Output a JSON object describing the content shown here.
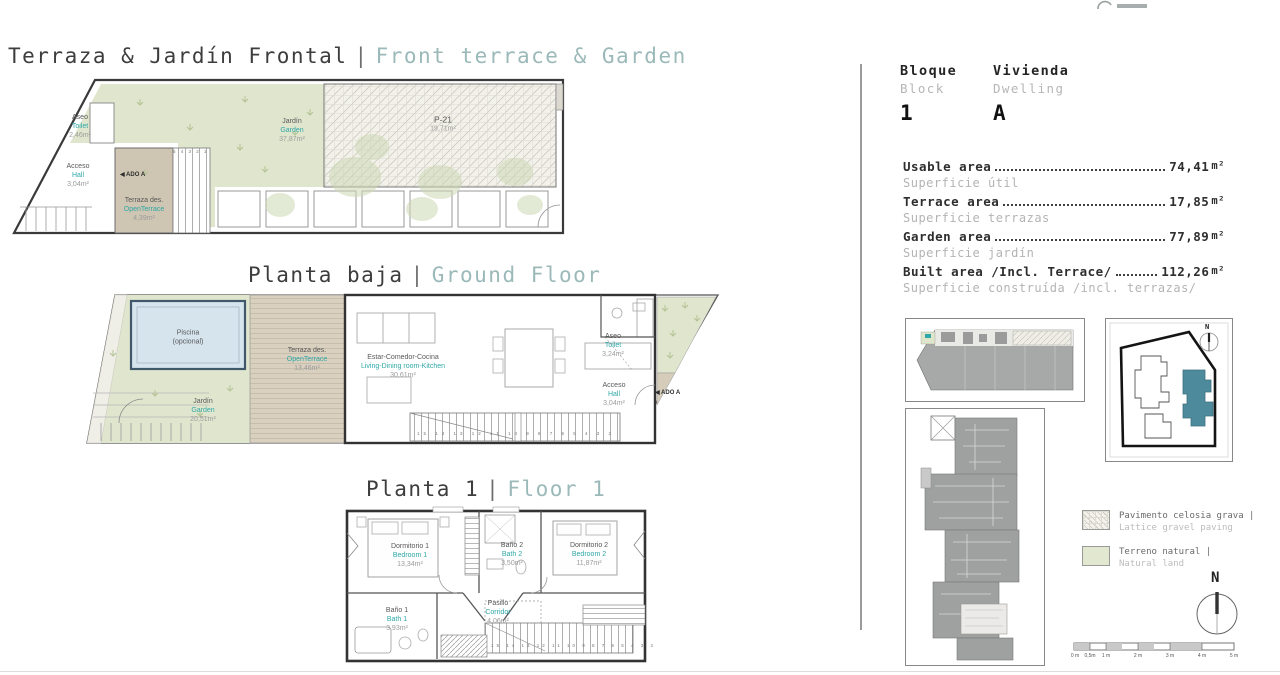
{
  "page": {
    "section1": {
      "title_es": "Terraza & Jardín Frontal",
      "sep": "|",
      "title_en": "Front terrace & Garden"
    },
    "section2": {
      "title_es": "Planta baja",
      "sep": "|",
      "title_en": "Ground Floor"
    },
    "section3": {
      "title_es": "Planta 1",
      "sep": "|",
      "title_en": "Floor 1"
    }
  },
  "plan_top": {
    "jardin": {
      "es": "Jardín",
      "en": "Garden",
      "area": "37,87m²"
    },
    "p21": {
      "name": "P-21",
      "area": "19,71m²"
    },
    "aseo": {
      "es": "Aseo",
      "en": "Toilet",
      "area": "2,46m²"
    },
    "acceso": {
      "es": "Acceso",
      "en": "Hall",
      "area": "3,04m²"
    },
    "terraza": {
      "es": "Terraza des.",
      "en": "OpenTerrace",
      "area": "4,39m²"
    },
    "marker_ado": "◀ ADO A",
    "stair_numbers": "5 4 3 2 1"
  },
  "plan_ground": {
    "piscina": {
      "line1": "Piscina",
      "line2": "(opcional)"
    },
    "terraza": {
      "es": "Terraza des.",
      "en": "OpenTerrace",
      "area": "13,46m²"
    },
    "estar": {
      "es": "Estar-Comedor-Cocina",
      "en": "Living-Dining room-Kitchen",
      "area": "30,61m²"
    },
    "aseo": {
      "es": "Aseo",
      "en": "Toilet",
      "area": "3,24m²"
    },
    "acceso": {
      "es": "Acceso",
      "en": "Hall",
      "area": "3,04m²"
    },
    "jardin": {
      "es": "Jardín",
      "en": "Garden",
      "area": "20,51m²"
    },
    "marker_ado": "◀ ADO A",
    "stair_numbers": "15 14 13 12 11 10 9 8 7 6 5 4 3 2"
  },
  "plan_floor1": {
    "dorm1": {
      "es": "Dormitorio 1",
      "en": "Bedroom 1",
      "area": "13,34m²"
    },
    "bano2": {
      "es": "Baño 2",
      "en": "Bath 2",
      "area": "3,50m²"
    },
    "dorm2": {
      "es": "Dormitorio 2",
      "en": "Bedroom 2",
      "area": "11,87m²"
    },
    "bano1": {
      "es": "Baño 1",
      "en": "Bath 1",
      "area": "3,93m²"
    },
    "pasillo": {
      "es": "Pasillo",
      "en": "Corridor",
      "area": "4,06m²"
    },
    "stair_numbers": "15 14 13 12 11 10 9 8 7 6 5 4 3 2"
  },
  "info": {
    "block": {
      "label_es": "Bloque",
      "label_en": "Block",
      "value": "1"
    },
    "dwelling": {
      "label_es": "Vivienda",
      "label_en": "Dwelling",
      "value": "A"
    },
    "areas": [
      {
        "en": "Usable area",
        "es": "Superficie útil",
        "value": "74,41",
        "unit": "m²"
      },
      {
        "en": "Terrace area",
        "es": "Superficie terrazas",
        "value": "17,85",
        "unit": "m²"
      },
      {
        "en": "Garden area",
        "es": "Superficie jardín",
        "value": "77,89",
        "unit": "m²"
      },
      {
        "en": "Built area /Incl. Terrace/",
        "es": "Superficie construída /incl. terrazas/",
        "value": "112,26",
        "unit": "m²"
      }
    ]
  },
  "legend": {
    "items": [
      {
        "es": "Pavimento celosia grava |",
        "en": "Lattice gravel paving"
      },
      {
        "es": "Terreno natural |",
        "en": "Natural land"
      }
    ]
  },
  "sitemap": {
    "north": "N"
  },
  "compass": {
    "north": "N"
  },
  "scalebar": {
    "labels": [
      "0 m",
      "0,5m",
      "1 m",
      "2 m",
      "3 m",
      "4 m",
      "5 m"
    ]
  },
  "colors": {
    "accent_teal": "#2fa8a8",
    "muted_teal": "#9cb9b9",
    "garden_green": "#e0e6ce",
    "terrace_tan": "#d8cfbf",
    "pool_blue": "#d6e4ee",
    "dwelling_teal": "#4d8a9c"
  }
}
